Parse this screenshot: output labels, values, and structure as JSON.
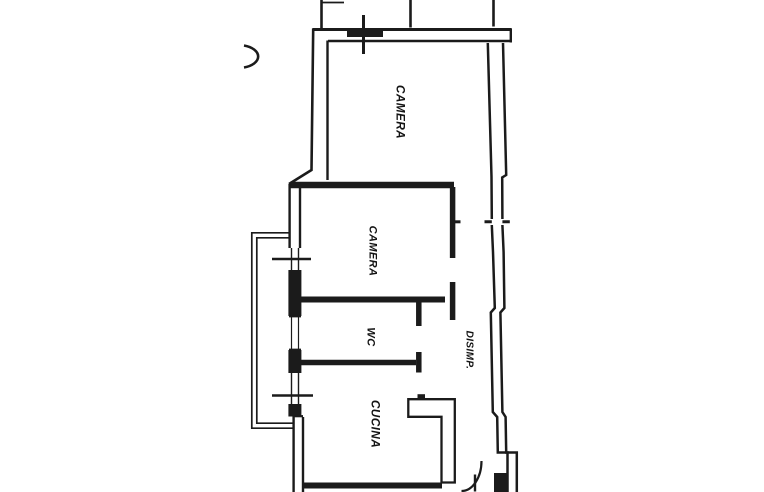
{
  "plan": {
    "title": "apartment-floor-plan",
    "rooms": [
      {
        "id": "camera-1",
        "label": "CAMERA"
      },
      {
        "id": "camera-2",
        "label": "CAMERA"
      },
      {
        "id": "wc",
        "label": "WC"
      },
      {
        "id": "disimp",
        "label": "DISIMP."
      },
      {
        "id": "cucina",
        "label": "CUCINA"
      }
    ],
    "colors": {
      "ink": "#1b1b1b",
      "paper": "#ffffff"
    }
  }
}
